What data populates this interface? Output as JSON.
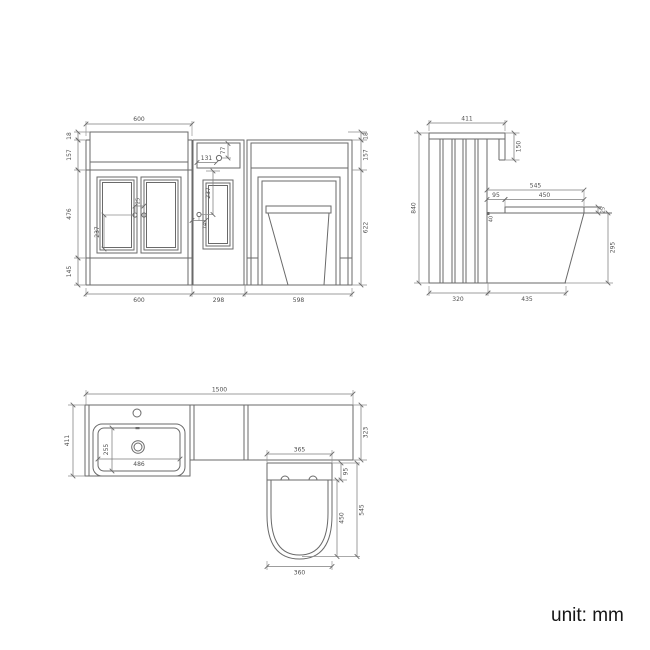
{
  "unit_label": "unit: mm",
  "front": {
    "top_width": "600",
    "worktop_thk": "18",
    "top_band": "157",
    "door_zone": "476",
    "plinth": "145",
    "right_thk": "18",
    "right_band": "157",
    "body_height": "622",
    "vanity_width": "600",
    "mid_width": "298",
    "wc_width": "598",
    "flush_offset_h": "131",
    "flush_offset_v": "77",
    "mid_door_height": "237",
    "mid_handle_offset": "74",
    "left_door_height": "237",
    "handle_spacing": "25"
  },
  "side": {
    "top_depth": "411",
    "worktop_return": "150",
    "unit_height": "840",
    "pan_projection": "545",
    "pan_gap": "95",
    "seat_length": "450",
    "seat_thickness": "25",
    "joint_gap": "40",
    "pan_front_height": "295",
    "base_depth": "320",
    "pan_depth": "435"
  },
  "plan": {
    "total_width": "1500",
    "vanity_depth": "411",
    "basin_depth": "255",
    "basin_width": "486",
    "run_depth": "323",
    "seat_top_width": "365",
    "seat_offset": "95",
    "seat_length": "450",
    "pan_projection": "545",
    "seat_bottom_width": "360"
  }
}
